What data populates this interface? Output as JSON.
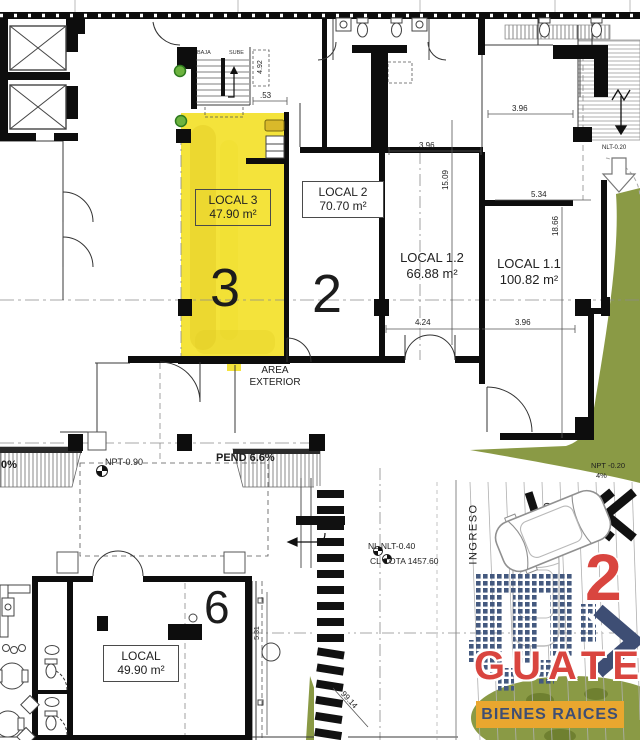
{
  "plan": {
    "locals": {
      "local3": {
        "name": "LOCAL 3",
        "area": "47.90 m²",
        "number": "3"
      },
      "local2": {
        "name": "LOCAL 2",
        "area": "70.70 m²",
        "number": "2"
      },
      "local12": {
        "name": "LOCAL 1.2",
        "area": "66.88 m²"
      },
      "local11": {
        "name": "LOCAL 1.1",
        "area": "100.82 m²"
      },
      "local6": {
        "name": "LOCAL",
        "area": "49.90 m²",
        "number": "6"
      }
    },
    "stairs": {
      "down": "BAJA",
      "up": "SUBE"
    },
    "levels": {
      "npt_street": "NPT-0.90",
      "npt_ramp": "NPT -0.20",
      "ramp_slope": "4%",
      "nlt_upper": "NLT-0.20",
      "nl_line": "NL NLT-0.40",
      "cl_line": "CL COTA 1457.60",
      "pend_main": "PEND 6.6%",
      "pend_left": "0%"
    },
    "annotations": {
      "area_exterior_line1": "AREA",
      "area_exterior_line2": "EXTERIOR",
      "ingreso": "INGRESO"
    },
    "dimensions": {
      "top_right": "3.96",
      "mid_top": "3.96",
      "local12_vert": "15.09",
      "upper_right": "5.34",
      "right_vert": "18.66",
      "mid_bottom": "4.24",
      "bottom_right": "3.96",
      "stair_clear": ".53",
      "stair_vert": "4.92",
      "walk_diag": "99.14",
      "room6_vert": "5.31"
    }
  },
  "logo": {
    "brand": "GUATE",
    "tagline": "BIENES RAICES",
    "mark": "2"
  },
  "colors": {
    "highlight_yellow": "#f4e33b",
    "landscape_green": "#8a9a45",
    "brand_red": "#d9453f",
    "brand_navy": "#3e4e74",
    "banner_gold": "#e9a72f"
  }
}
